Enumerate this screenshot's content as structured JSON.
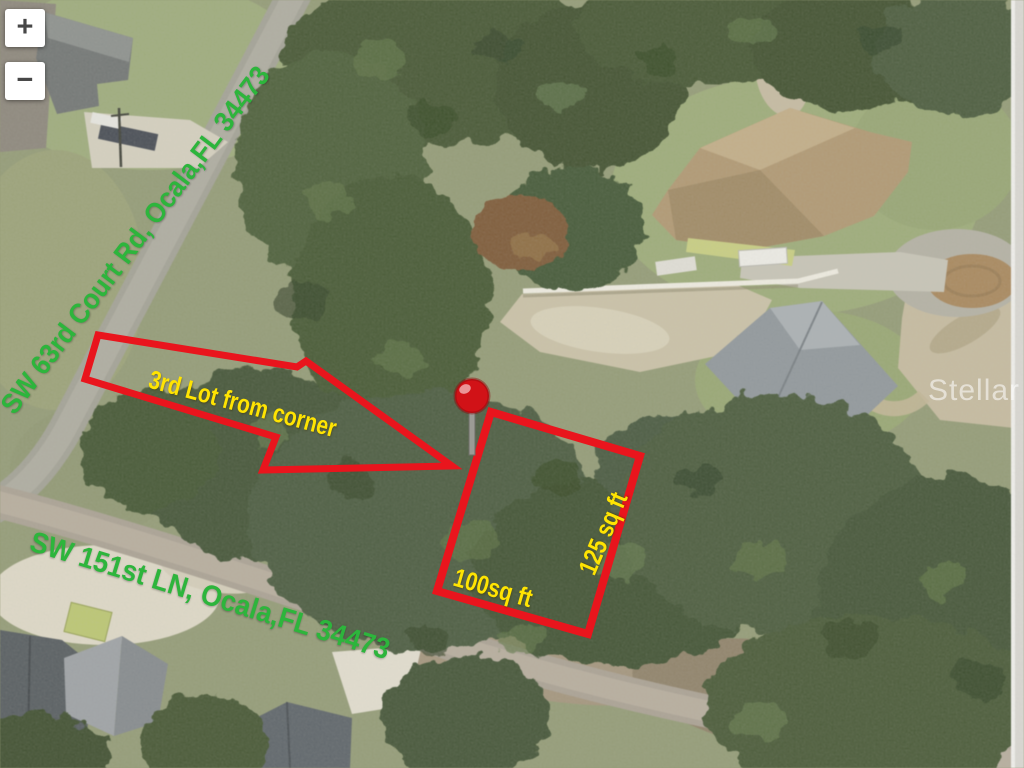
{
  "map": {
    "controls": {
      "zoom_in_label": "+",
      "zoom_out_label": "−"
    },
    "watermark_text": "Stellar MLS",
    "annotations": {
      "street_label_vertical": "SW 63rd Court Rd, Ocala,FL 34473",
      "street_label_horizontal": "SW 151st LN, Ocala,FL 34473",
      "arrow_label": "3rd Lot from corner",
      "lot_front_label": "100sq ft",
      "lot_side_label": "125 sq ft"
    },
    "colors": {
      "annotation_red": "#e9151d",
      "annotation_yellow": "#ffe402",
      "street_green": "#2db53c",
      "pin_red": "#d11217"
    }
  }
}
